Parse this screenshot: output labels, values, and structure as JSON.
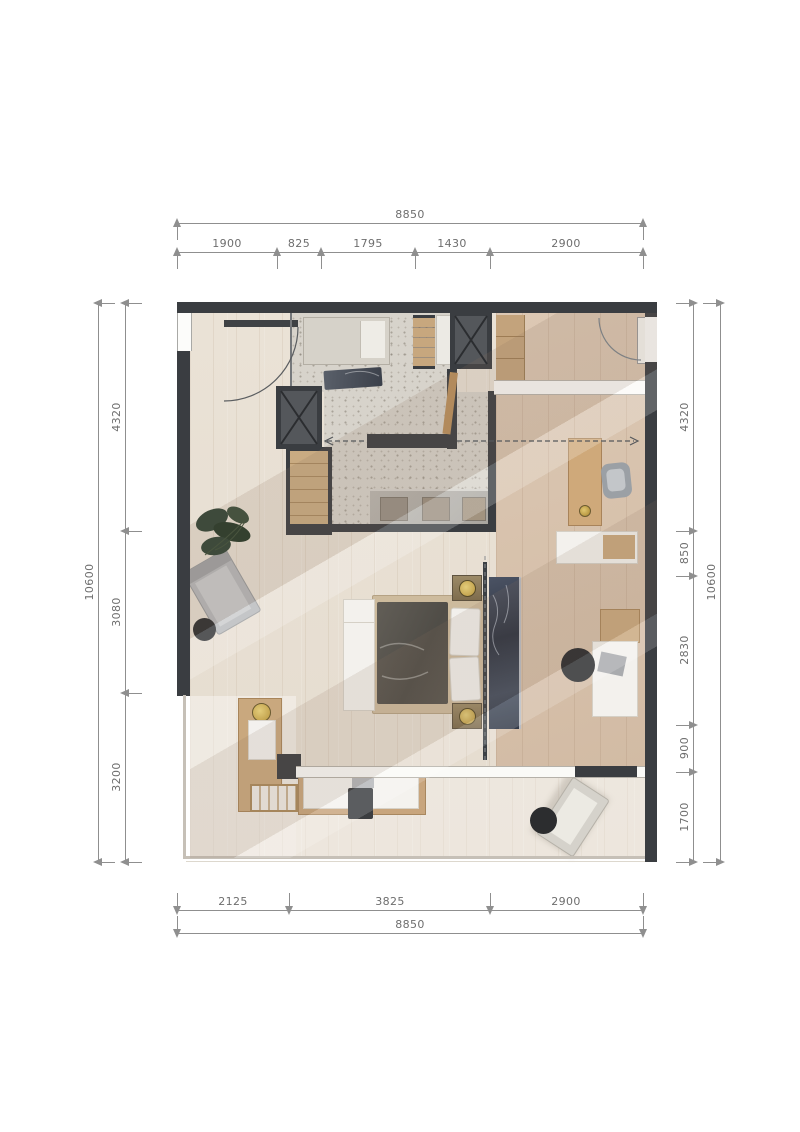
{
  "dims": {
    "top": {
      "total": "8850",
      "segs": [
        "1900",
        "825",
        "1795",
        "1430",
        "2900"
      ]
    },
    "bottom": {
      "total": "8850",
      "segs": [
        "2125",
        "3825",
        "2900"
      ]
    },
    "left": {
      "total": "10600",
      "segs": [
        "4320",
        "3080",
        "3200"
      ]
    },
    "right": {
      "total": "10600",
      "segs": [
        "4320",
        "850",
        "2830",
        "900",
        "1700"
      ]
    }
  },
  "colors": {
    "wall": "#3a3d41",
    "wood_light": "#e9e1d6",
    "wood_warm": "#d8c2ad",
    "terrazzo": "#d7d3cb",
    "marble_dark": "#323947",
    "gold": "#cfae55",
    "white_furniture": "#f3f1ec",
    "black_accent": "#2c2d2f",
    "dim_line": "#8f8f8f",
    "dim_text": "#6e6e6e"
  }
}
